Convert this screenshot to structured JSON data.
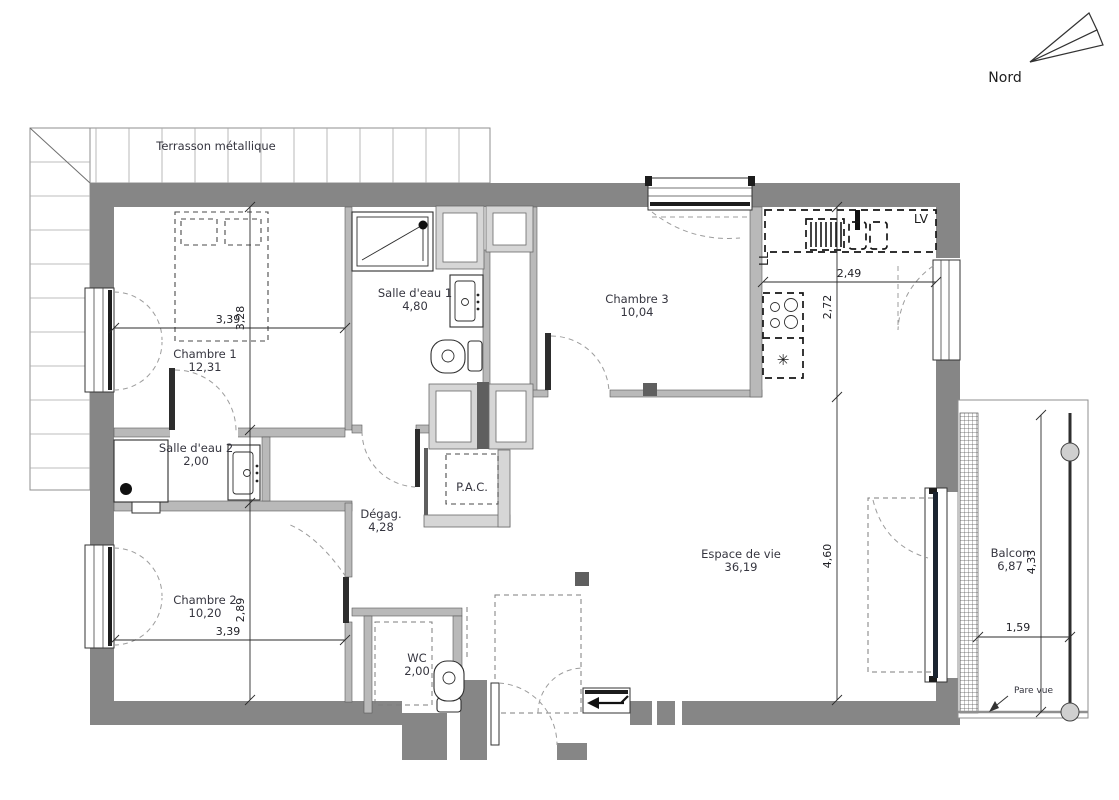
{
  "compass": {
    "label": "Nord"
  },
  "terrace": {
    "label": "Terrasson métallique"
  },
  "rooms": [
    {
      "id": "chambre1",
      "name": "Chambre 1",
      "area": "12,31"
    },
    {
      "id": "salle_eau1",
      "name": "Salle d'eau 1",
      "area": "4,80"
    },
    {
      "id": "chambre3",
      "name": "Chambre 3",
      "area": "10,04"
    },
    {
      "id": "salle_eau2",
      "name": "Salle d'eau 2",
      "area": "2,00"
    },
    {
      "id": "degagement",
      "name": "Dégag.",
      "area": "4,28"
    },
    {
      "id": "chambre2",
      "name": "Chambre 2",
      "area": "10,20"
    },
    {
      "id": "wc",
      "name": "WC",
      "area": "2,00"
    },
    {
      "id": "espace_de_vie",
      "name": "Espace de vie",
      "area": "36,19"
    },
    {
      "id": "balcon",
      "name": "Balcon",
      "area": "6,87"
    }
  ],
  "equipment": {
    "pac": "P.A.C.",
    "lave_vaisselle": "LV",
    "lave_linge": "LL"
  },
  "annotations": {
    "pare_vue": "Pare vue"
  },
  "dimensions": {
    "chambre1_width": "3,39",
    "chambre1_depth": "3,28",
    "cuisine_width": "2,49",
    "cuisine_depth": "2,72",
    "sejour_depth": "4,60",
    "chambre2_depth": "2,89",
    "chambre2_width": "3,39",
    "balcon_width": "1,59",
    "balcon_depth": "4,33"
  },
  "colors": {
    "wall": "#868686",
    "partition": "#b9b9b9",
    "dashed_equipment": "#161616",
    "swing_arc": "#9c9c9c",
    "text": "#35353f"
  }
}
